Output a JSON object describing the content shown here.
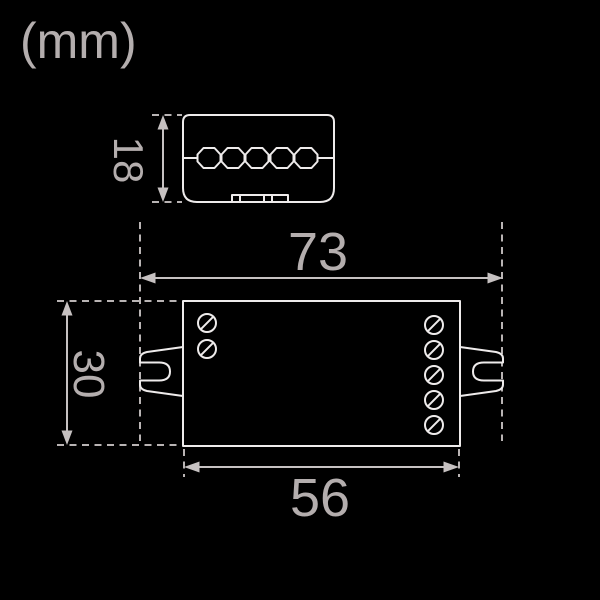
{
  "title": {
    "unit_label": "(mm)"
  },
  "colors": {
    "background": "#000000",
    "device_outline": "#eeebeb",
    "dimension_line": "#c6c1c1",
    "dashed_line": "#b9b4b4",
    "label_text": "#b4aeae"
  },
  "side_view": {
    "description": "side profile of controller module",
    "height_dim_label": "18",
    "terminal_knob_count": 5
  },
  "front_view": {
    "description": "top view of controller module with mounting tabs",
    "overall_width_label": "73",
    "body_width_label": "56",
    "depth_dim_label": "30",
    "left_screw_count": 2,
    "right_screw_count": 5
  }
}
